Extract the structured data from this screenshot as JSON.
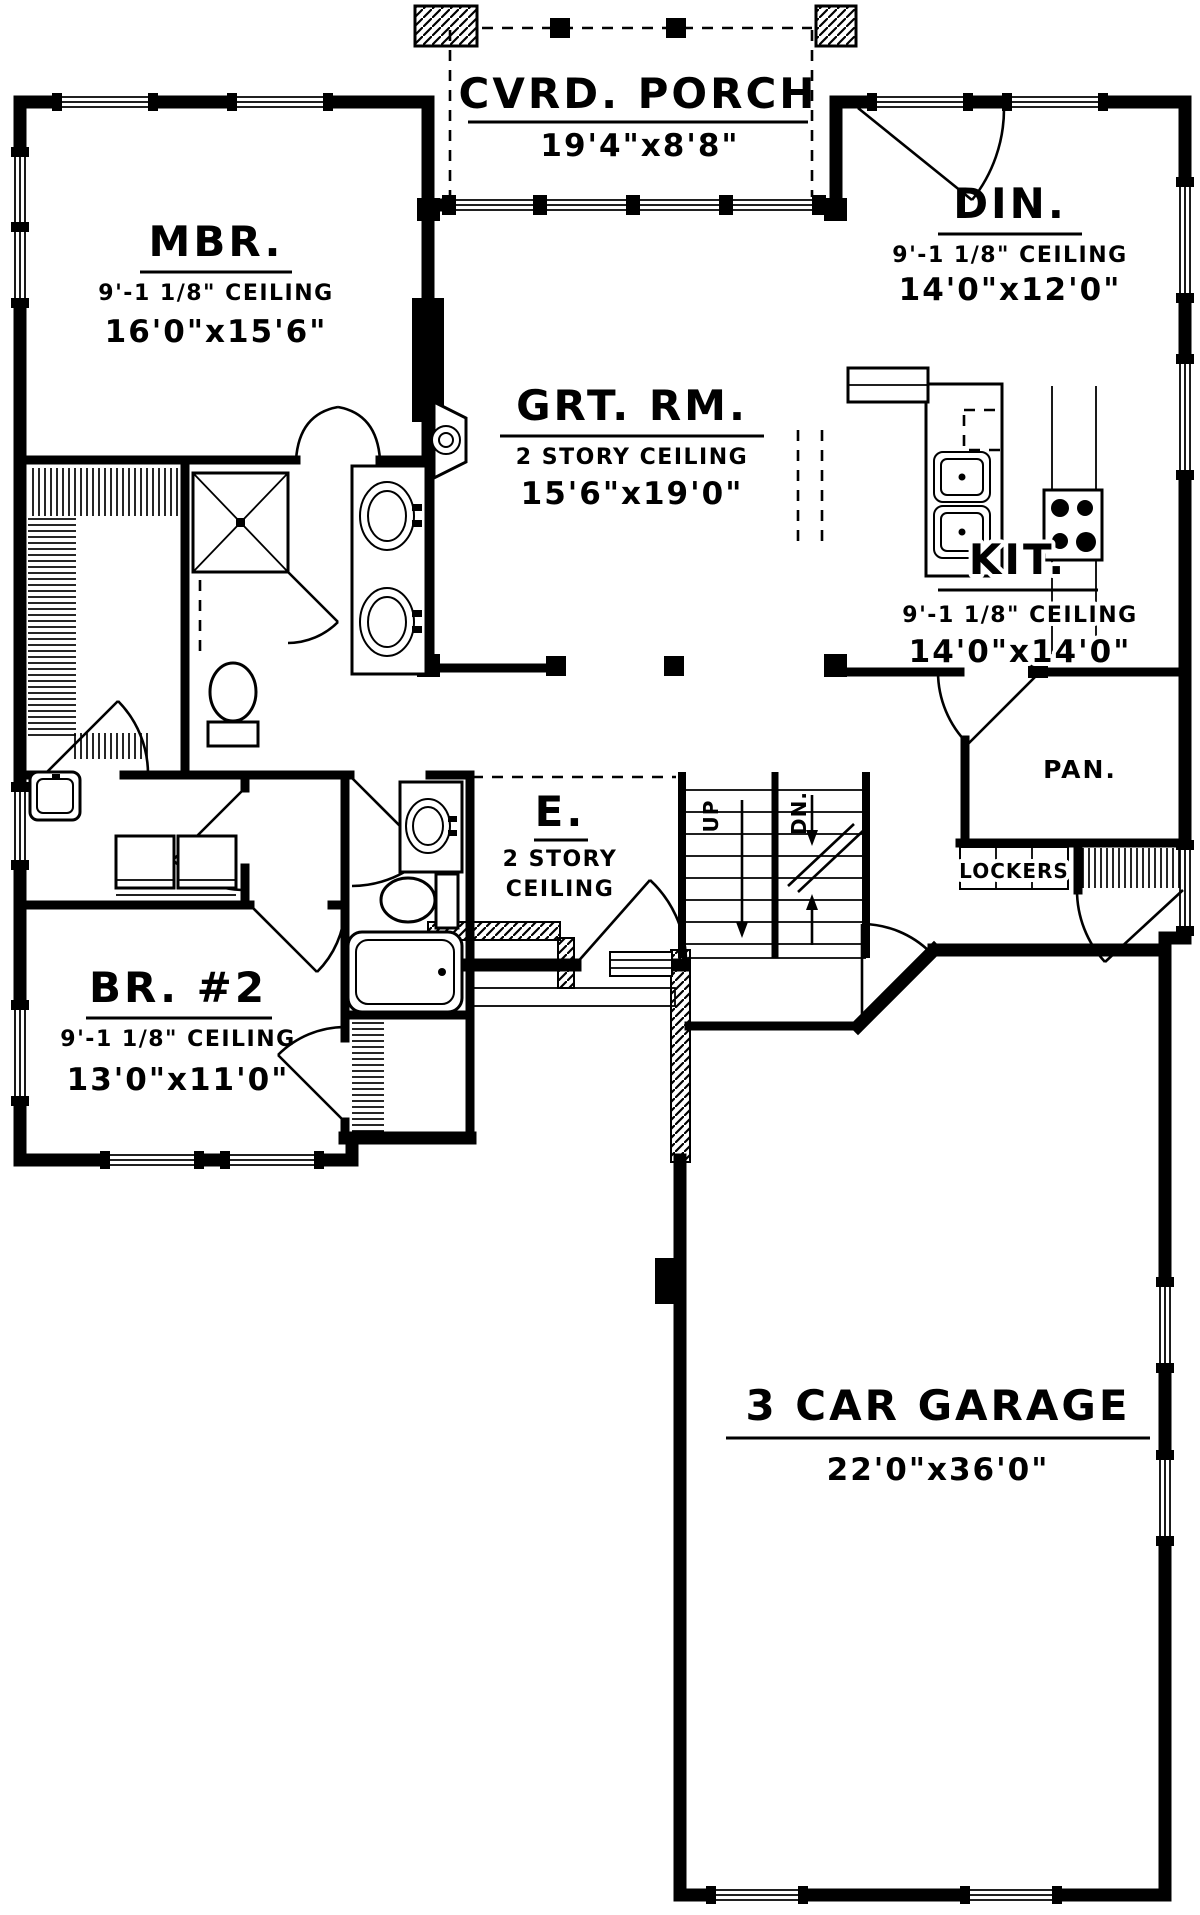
{
  "rooms": {
    "porch": {
      "name": "CVRD. PORCH",
      "dims": "19'4\"x8'8\""
    },
    "mbr": {
      "name": "MBR.",
      "ceiling": "9'-1 1/8\" CEILING",
      "dims": "16'0\"x15'6\""
    },
    "din": {
      "name": "DIN.",
      "ceiling": "9'-1 1/8\" CEILING",
      "dims": "14'0\"x12'0\""
    },
    "grt": {
      "name": "GRT. RM.",
      "ceiling": "2 STORY CEILING",
      "dims": "15'6\"x19'0\""
    },
    "kit": {
      "name": "KIT.",
      "ceiling": "9'-1 1/8\" CEILING",
      "dims": "14'0\"x14'0\""
    },
    "pan": {
      "name": "PAN."
    },
    "lockers": {
      "name": "LOCKERS"
    },
    "entry": {
      "name": "E.",
      "ceiling_line1": "2 STORY",
      "ceiling_line2": "CEILING"
    },
    "br2": {
      "name": "BR. #2",
      "ceiling": "9'-1 1/8\" CEILING",
      "dims": "13'0\"x11'0\""
    },
    "garage": {
      "name": "3 CAR GARAGE",
      "dims": "22'0\"x36'0\""
    },
    "stairs": {
      "up": "UP",
      "dn": "DN."
    }
  },
  "colors": {
    "ink": "#000000",
    "paper": "#ffffff"
  }
}
